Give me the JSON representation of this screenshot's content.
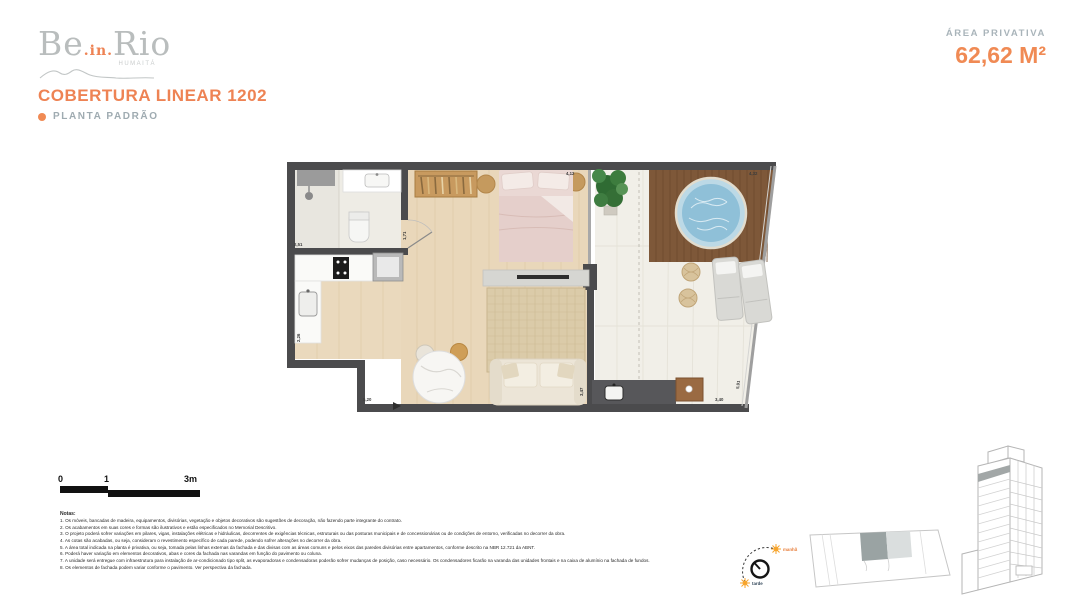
{
  "brand": {
    "logo_be": "Be",
    "logo_in": ".in.",
    "logo_rio": "Rio",
    "logo_sub": "HUMAITÁ"
  },
  "header": {
    "title": "COBERTURA LINEAR 1202",
    "subtitle": "PLANTA PADRÃO"
  },
  "area": {
    "label": "ÁREA PRIVATIVA",
    "value": "62,62 M²"
  },
  "floorplan": {
    "dims": {
      "bath_width": "2,51",
      "bath_height": "1,71",
      "bedroom_width": "4,12",
      "deck_width": "4,32",
      "kitchen_height": "2,26",
      "living_width": "5,20",
      "living_height": "3,47",
      "terrace_width": "3,40",
      "facade_diagonal": "5,91"
    }
  },
  "scalebar": {
    "zero": "0",
    "one": "1",
    "three": "3m"
  },
  "notes": {
    "heading": "Notas:",
    "items": [
      "1. Os móveis, bancadas de madeira, equipamentos, divisórias, vegetação e objetos decorativos são sugestões de decoração, não fazendo parte integrante do contrato.",
      "2. Os acabamentos em suas cores e formas são ilustrativos e estão especificados no Memorial Descritivo.",
      "3. O projeto poderá sofrer variações em pilares, vigas, instalações elétricas e hidráulicas, decorrentes de exigências técnicas, estruturais ou das posturas municipais e de concessionárias ou de condições de entorno, verificadas no decorrer da obra.",
      "4. As cotas são acabadas, ou seja, consideram o revestimento específico de cada parede, podendo sofrer alterações no decorrer da obra.",
      "5. A área total indicada na planta é privativa, ou seja, tomada pelas linhas externas da fachada e das divisas com as áreas comuns e pelos eixos das paredes divisórias entre apartamentos, conforme descrito na NBR 12.721 da ABNT.",
      "6. Poderá haver variação em elementos decorativos, abas e cores da fachada nas varandas em função do pavimento ou coluna.",
      "7. A unidade será entregue com infraestrutura para instalação de ar-condicionado tipo split, as evaporadoras e condensadoras poderão sofrer mudanças de posição, caso necessário. Os condensadores ficarão na varanda das unidades frontais e na caixa de alumínio na fachada de fundos.",
      "8. Os elementos de fachada podem variar conforme o pavimento. Ver perspectiva da fachada."
    ]
  },
  "compass": {
    "morning": "manhã",
    "afternoon": "tarde"
  },
  "colors": {
    "accent_orange": "#F08A54",
    "muted_gray_blue": "#9FABB1",
    "wall_dark": "#4B4B4D",
    "wood_floor": "#E9D7BA",
    "deck_wood": "#7E5839",
    "pool_blue": "#8FC0D8"
  }
}
